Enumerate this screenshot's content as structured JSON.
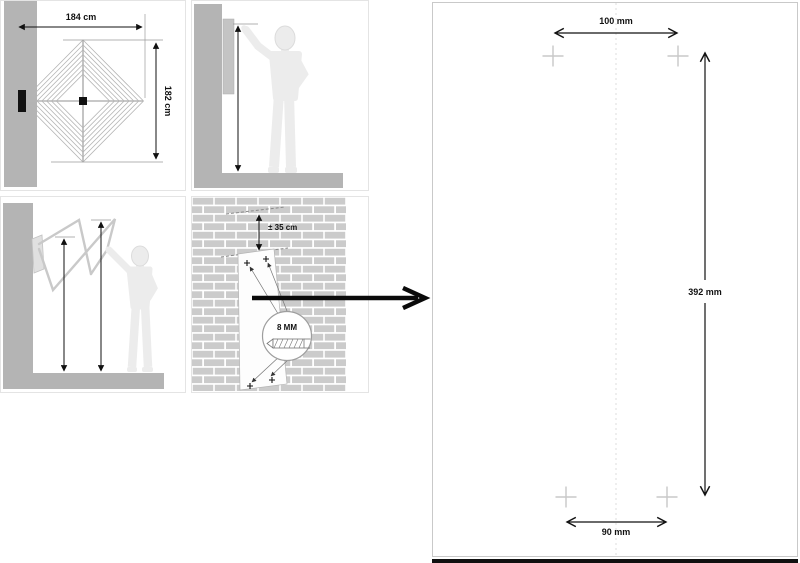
{
  "colors": {
    "wall_gray": "#b4b4b4",
    "brick_gray": "#cbcbcb",
    "figure_gray": "#ececec",
    "frame_gray": "#c9c9c9",
    "dimension_ink": "#111111",
    "cross_gray": "#c8c8c8",
    "arrow_black": "#0a0a0a"
  },
  "panel_dryer_front": {
    "width_label": "184 cm",
    "height_label": "182 cm"
  },
  "panel_wall_mount": {
    "offset_label": "± 35 cm",
    "drill_diameter_label": "8 MM"
  },
  "drill_template": {
    "top_hole_spacing_label": "100 mm",
    "vertical_hole_spacing_label": "392 mm",
    "bottom_hole_spacing_label": "90 mm"
  }
}
